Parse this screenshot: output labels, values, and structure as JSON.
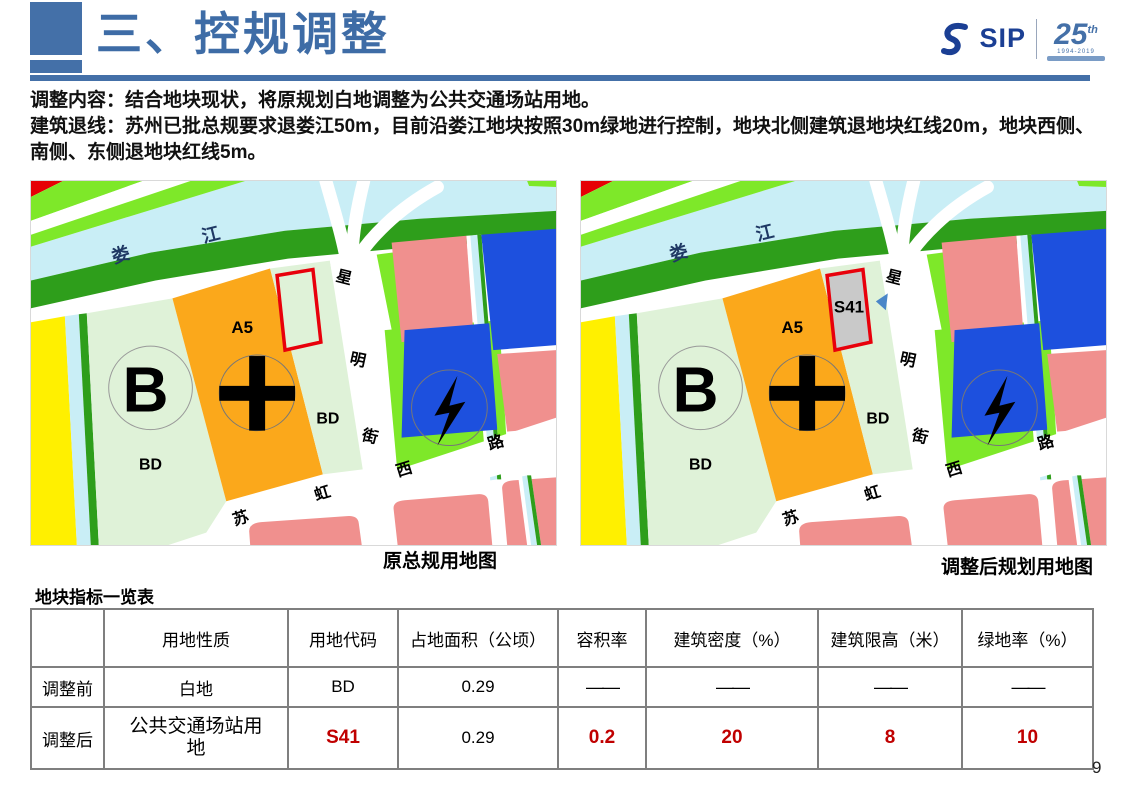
{
  "header": {
    "title": "三、控规调整",
    "logo_text": "SIP",
    "logo_anniversary": "25",
    "logo_anniversary_sup": "th",
    "logo_years": "1994-2019"
  },
  "intro": {
    "line1": "调整内容：结合地块现状，将原规划白地调整为公共交通场站用地。",
    "line2": "建筑退线：苏州已批总规要求退娄江50m，目前沿娄江地块按照30m绿地进行控制，地块北侧建筑退地块红线20m，地块西侧、南侧、东侧退地块红线5m。"
  },
  "maps": {
    "left_caption": "原总规用地图",
    "right_caption": "调整后规划用地图",
    "labels": {
      "river_lou": "娄",
      "river_jiang": "江",
      "parcel_b": "B",
      "parcel_a5": "A5",
      "parcel_bd": "BD",
      "street_xing": "星",
      "street_ming": "明",
      "street_jie": "街",
      "road_su": "苏",
      "road_hong": "虹",
      "road_xi": "西",
      "road_lu": "路",
      "parcel_s41": "S41"
    }
  },
  "table": {
    "title": "地块指标一览表",
    "headers": [
      "",
      "用地性质",
      "用地代码",
      "占地面积（公顷）",
      "容积率",
      "建筑密度（%）",
      "建筑限高（米）",
      "绿地率（%）"
    ],
    "rows": [
      {
        "label": "调整前",
        "cells": [
          "白地",
          "BD",
          "0.29",
          "——",
          "——",
          "——",
          "——"
        ]
      },
      {
        "label": "调整后",
        "cells": [
          "公共交通场站用地",
          "S41",
          "0.29",
          "0.2",
          "20",
          "8",
          "10"
        ]
      }
    ]
  },
  "page": {
    "number": "9"
  }
}
